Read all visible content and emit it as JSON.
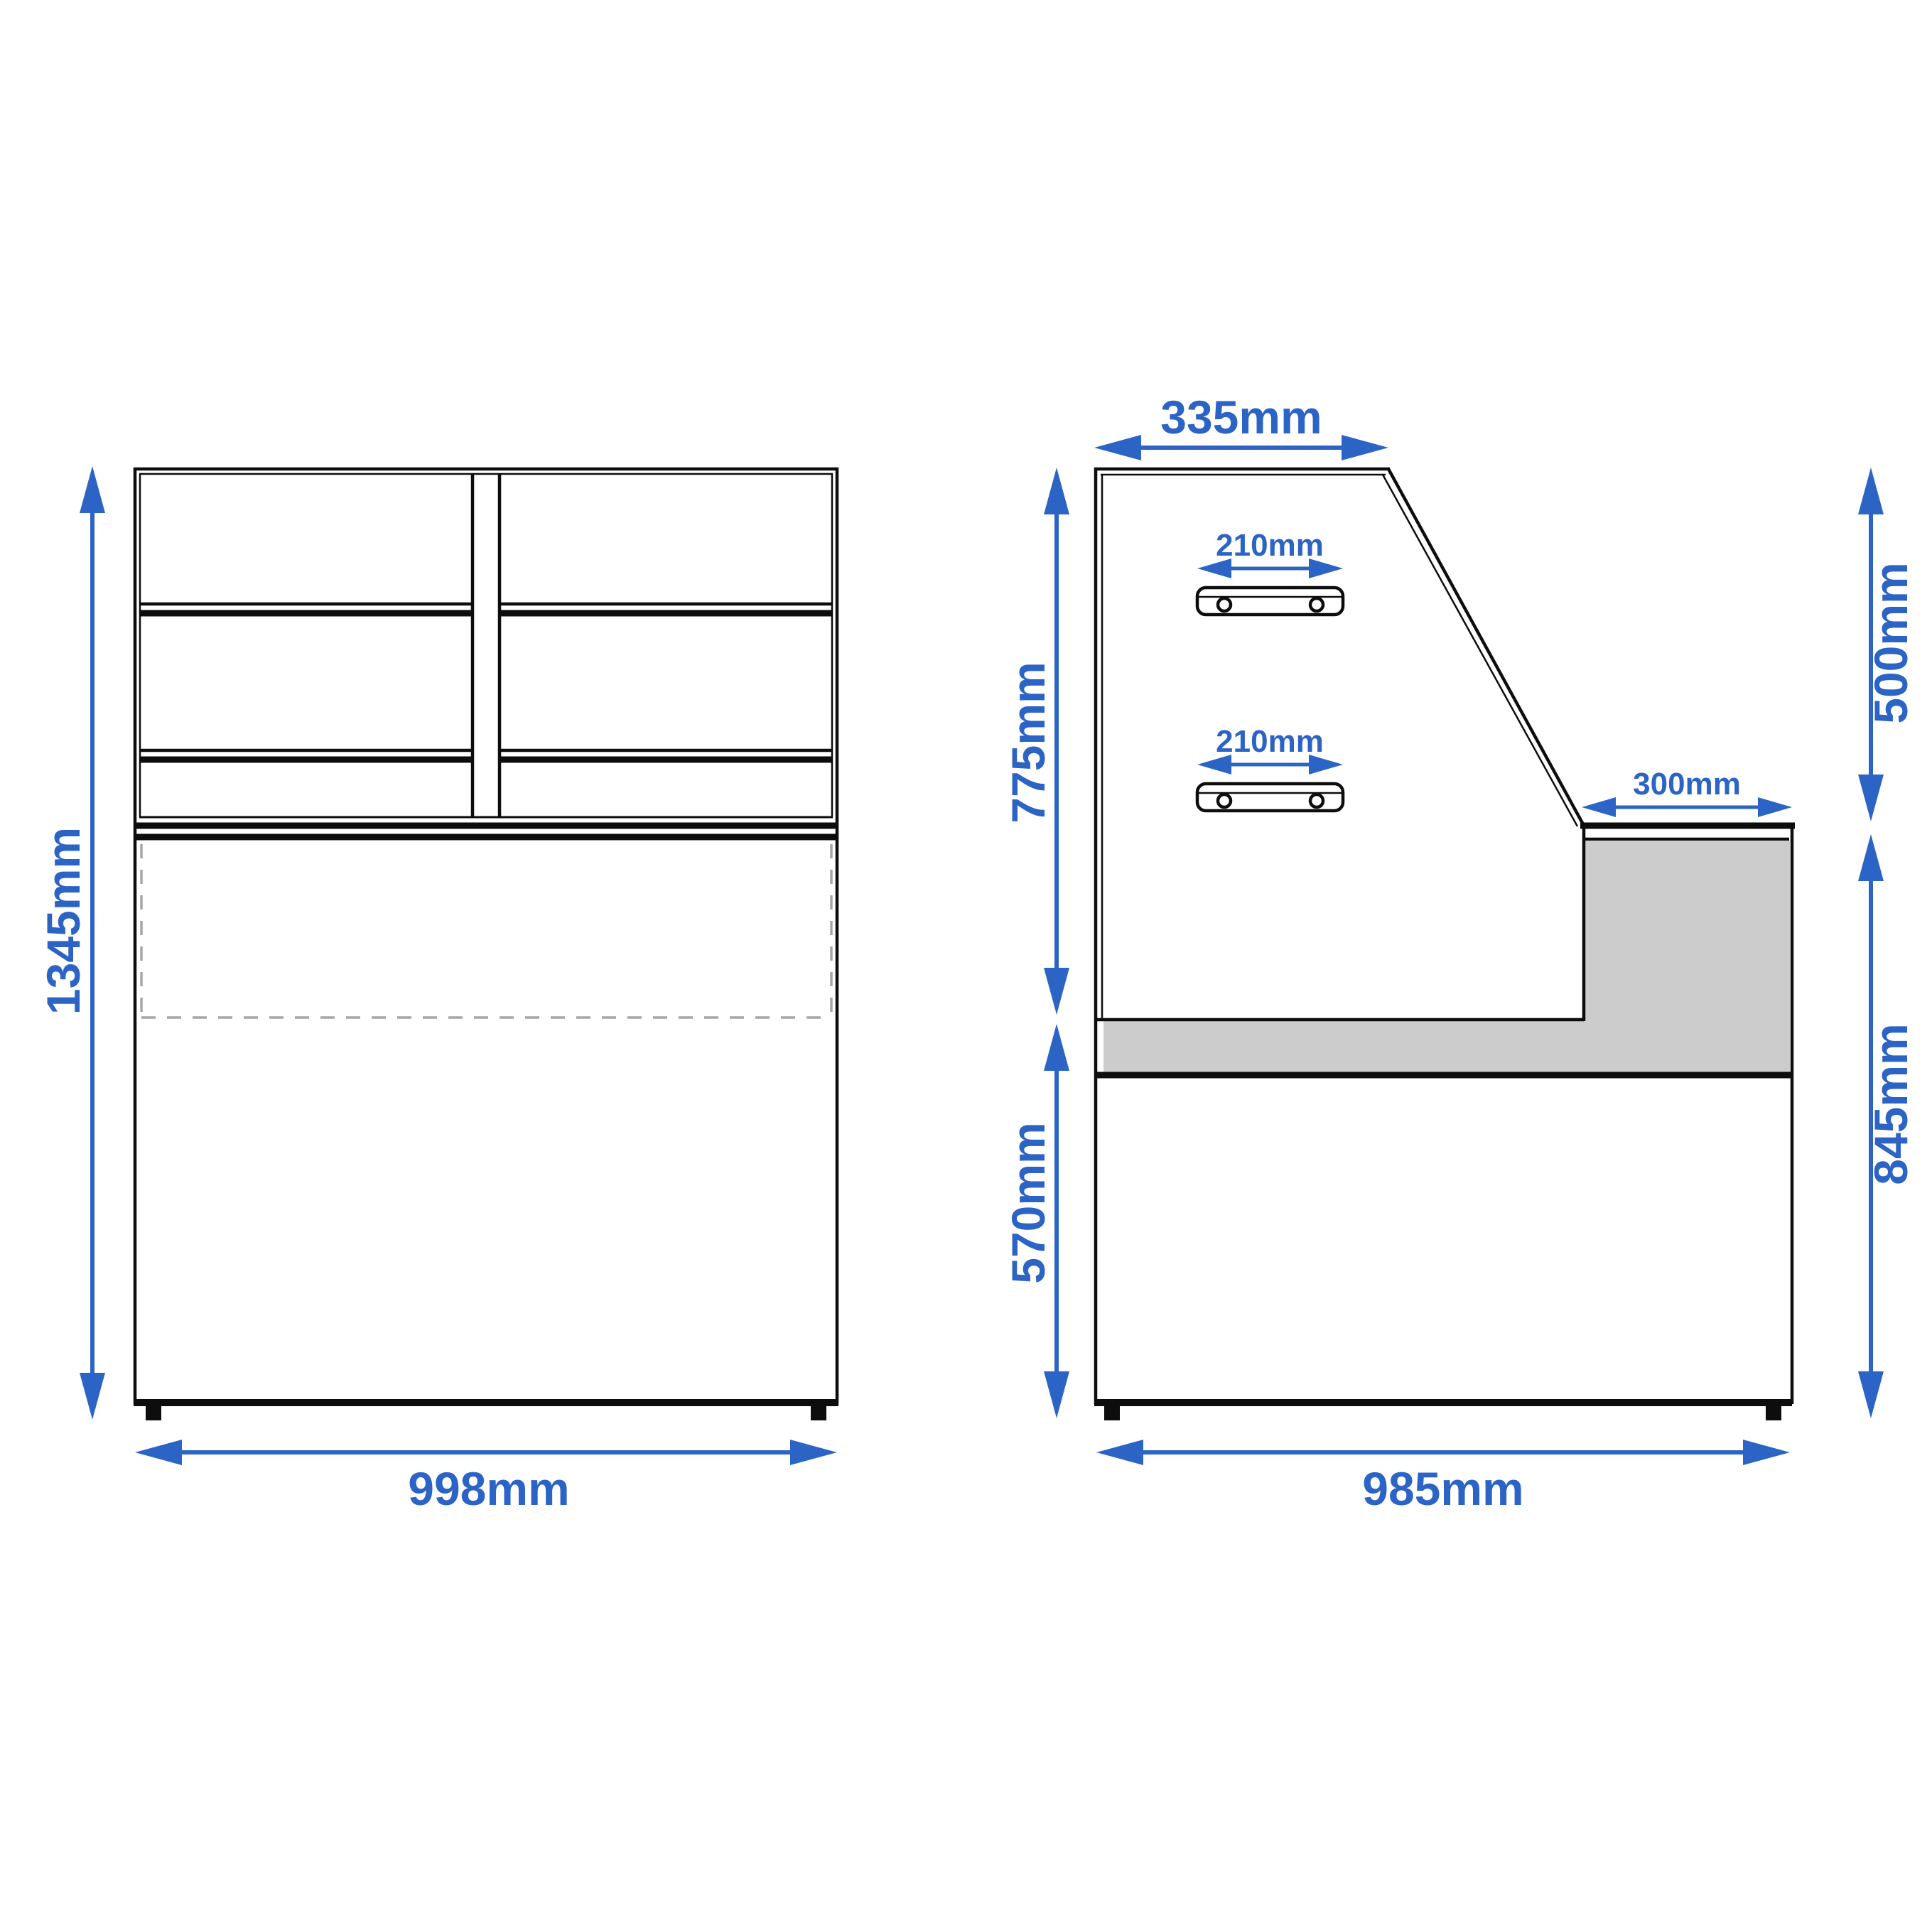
{
  "colors": {
    "dimension_blue": "#2c64c6",
    "line_black": "#0d0d0d",
    "panel_gray": "#cccccc",
    "dashed_gray": "#a6a6a6",
    "background": "#ffffff"
  },
  "front_view": {
    "height_label": "1345mm",
    "width_label": "998mm"
  },
  "side_view": {
    "top_width_label": "335mm",
    "upper_bracket_label": "210mm",
    "lower_bracket_label": "210mm",
    "counter_depth_label": "300mm",
    "upper_left_height_label": "775mm",
    "lower_left_height_label": "570mm",
    "upper_right_height_label": "500mm",
    "lower_right_height_label": "845mm",
    "bottom_width_label": "985mm"
  }
}
